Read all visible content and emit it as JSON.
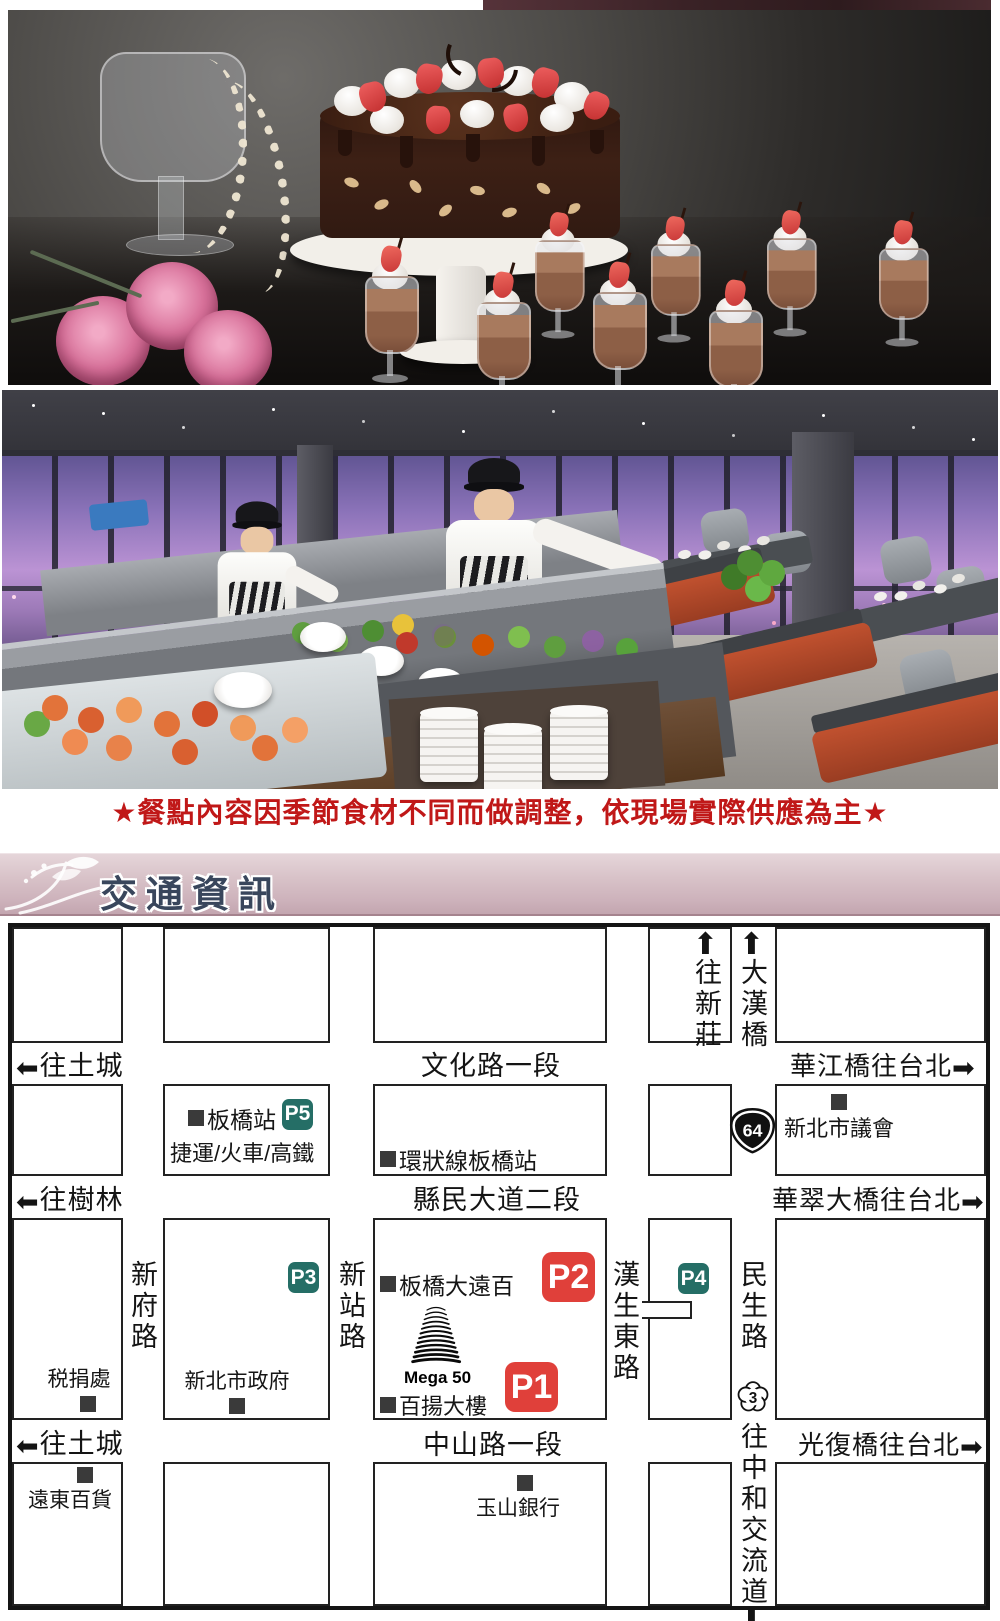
{
  "notice": {
    "text": "★餐點內容因季節食材不同而做調整，依現場實際供應為主★"
  },
  "section_header": {
    "title": "交通資訊"
  },
  "icons": {
    "left_arrow": "⬅",
    "right_arrow": "➡",
    "up_arrow": "⬆",
    "down_arrow": "⬇"
  },
  "map": {
    "top_directions": [
      "往新莊",
      "大漢橋"
    ],
    "exits_left": [
      "往土城",
      "往樹林",
      "往土城"
    ],
    "roads_horizontal": [
      "文化路一段",
      "縣民大道二段",
      "中山路一段"
    ],
    "exits_right": [
      "華江橋往台北",
      "華翠大橋往台北",
      "光復橋往台北"
    ],
    "roads_vertical": [
      "新府路",
      "新站路",
      "漢生東路",
      "民生路"
    ],
    "bottom_direction": "往中和交流道",
    "highway_badges": [
      "64",
      "3"
    ],
    "parking": {
      "p1": "P1",
      "p2": "P2",
      "p3": "P3",
      "p4": "P4",
      "p5": "P5"
    },
    "pois": {
      "banqiao_station": {
        "name": "板橋站",
        "sub": "捷運/火車/高鐵"
      },
      "circular_line": "環狀線板橋站",
      "city_council": "新北市議會",
      "far_eastern_mall": "板橋大遠百",
      "city_hall": "新北市政府",
      "tax_office": "税捐處",
      "mega50": {
        "en": "Mega 50",
        "zh": "百揚大樓"
      },
      "esun_bank": "玉山銀行",
      "fe_department_store": "遠東百貨"
    },
    "colors": {
      "parking_red": "#e0403a",
      "parking_teal": "#256e66",
      "notice_red": "#c01818",
      "banner_text": "#39465c",
      "banner_bg": "#d8c2c8"
    }
  }
}
